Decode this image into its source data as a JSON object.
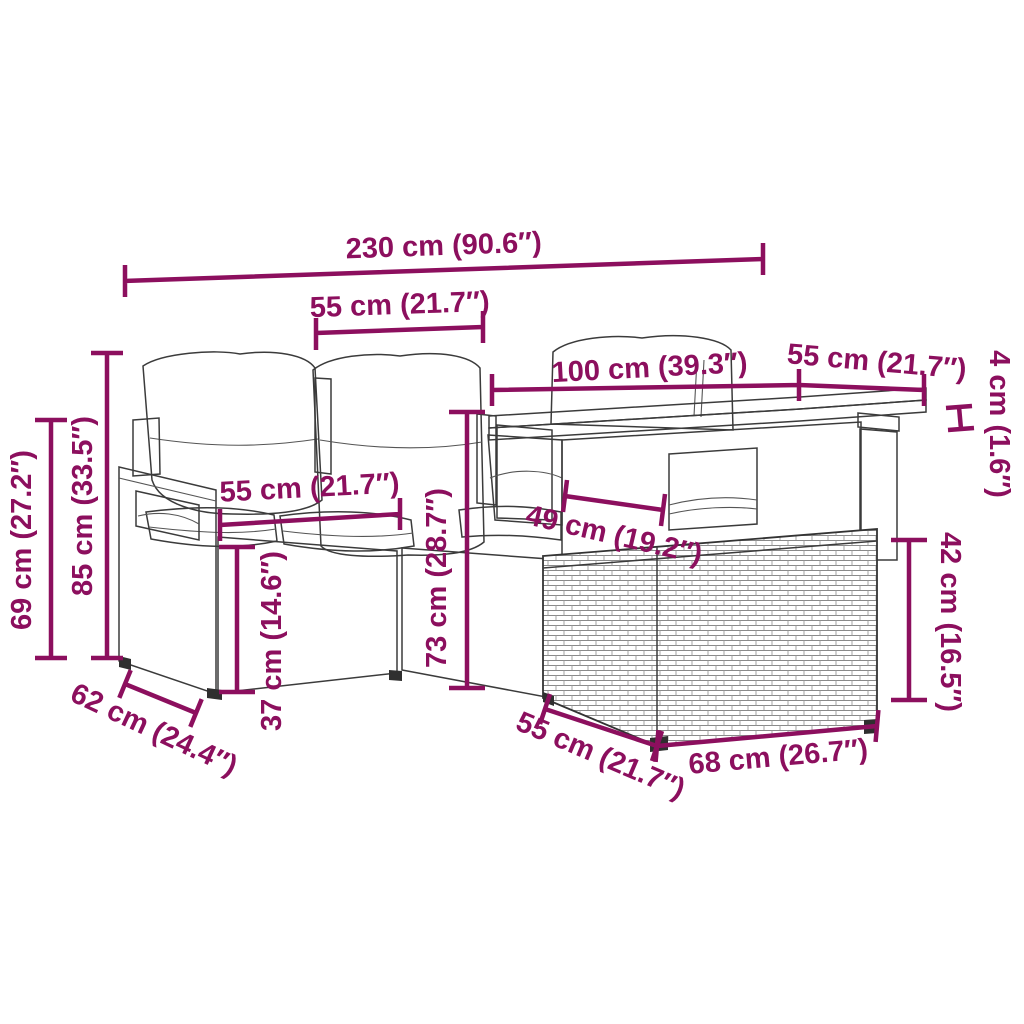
{
  "title": "Rattan garden furniture set — dimension diagram",
  "colors": {
    "accent": "#8C0F5E",
    "line": "#3b3b3b",
    "background": "#ffffff"
  },
  "dims": {
    "overall_width": "230 cm (90.6″)",
    "seat_width": "55 cm (21.7″)",
    "table_length": "100 cm (39.3″)",
    "table_depth": "55 cm (21.7″)",
    "tabletop_thickness": "4 cm (1.6″)",
    "backrest_height": "69 cm (27.2″)",
    "total_height": "85 cm (33.5″)",
    "sofa_depth": "62 cm (24.4″)",
    "seat_depth": "55 cm (21.7″)",
    "seat_height": "37 cm (14.6″)",
    "table_height": "73 cm (28.7″)",
    "table_base_width": "49 cm (19.2″)",
    "stool_height": "42 cm (16.5″)",
    "stool_depth": "55 cm (21.7″)",
    "stool_width": "68 cm (26.7″)"
  }
}
